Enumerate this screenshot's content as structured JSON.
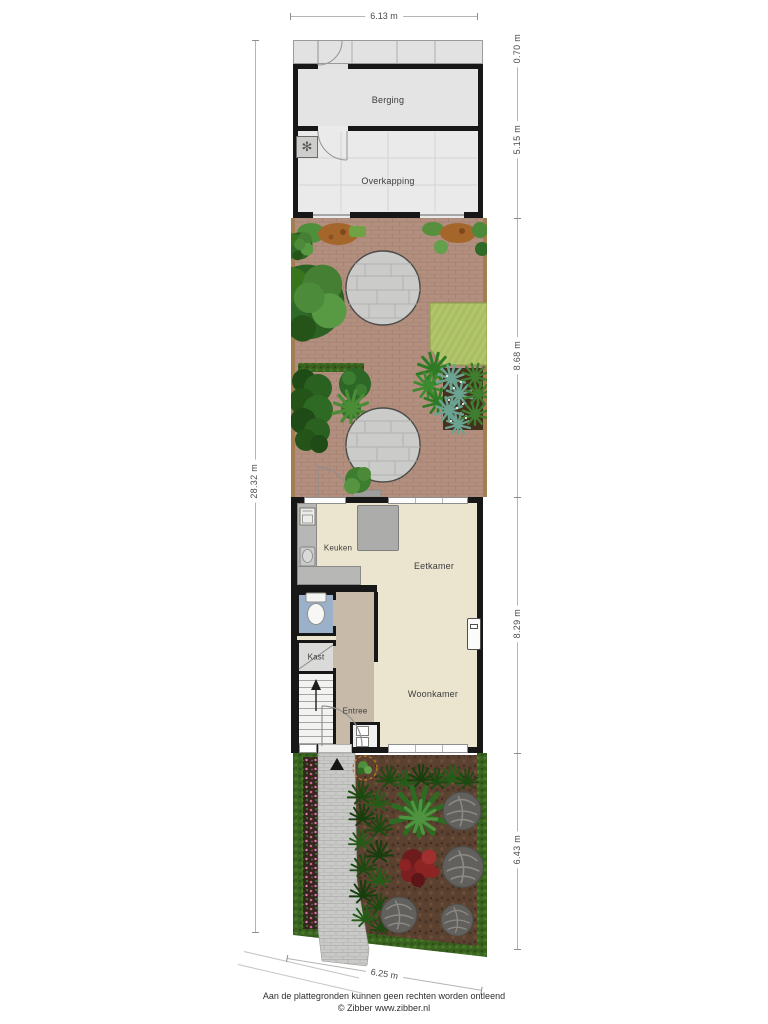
{
  "dimensions": {
    "top": "6.13 m",
    "bottom": "6.25 m",
    "left": "28.32 m",
    "right": [
      "0.70 m",
      "5.15 m",
      "8.68 m",
      "8.29 m",
      "6.43 m"
    ]
  },
  "rooms": {
    "berging": "Berging",
    "overkapping": "Overkapping",
    "keuken": "Keuken",
    "eetkamer": "Eetkamer",
    "kast": "Kast",
    "entree": "Entree",
    "woonkamer": "Woonkamer"
  },
  "footer": {
    "disclaimer": "Aan de plattegronden kunnen geen rechten worden ontleend",
    "copyright": "© Zibber www.zibber.nl"
  },
  "icons": {
    "heat_pump": "fan-unit-square",
    "entrance_marker": "black-triangle",
    "toilet": "toilet-top-view",
    "stairs": "staircase-with-up-arrow",
    "meter_cabinet": "two-utility-meters",
    "radiator": "wall-radiator",
    "sink": "kitchen-sink",
    "oven": "built-in-appliance",
    "new_tree": "dashed-circle-plant"
  },
  "colors": {
    "wall": "#171717",
    "shed_floor": "#e4e4e4",
    "living_floor": "#ebe5d0",
    "entree_floor": "#c8baa9",
    "toilet_floor": "#9ab1c9",
    "counter": "#b7b7b5",
    "garden_paving": "#b28f7e",
    "patio_stone": "#cbcbc9",
    "lawn": "#a9bd62",
    "hedge": "#3a6420",
    "soil": "#5a4130",
    "path": "#c9c9c7",
    "flowers_pink": "#cb5f9e",
    "plants_red": "#8c2424"
  }
}
